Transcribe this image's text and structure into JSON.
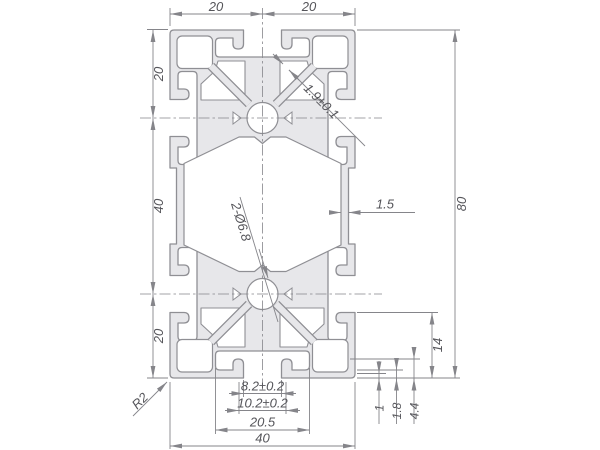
{
  "drawing": {
    "colors": {
      "profile_fill": "#e7e7ea",
      "profile_stroke": "#8f8f94",
      "dimension_line": "#85858a",
      "text": "#55555a"
    },
    "dimensions": {
      "top_width_left": "20",
      "top_width_right": "20",
      "left_height_top": "20",
      "left_height_middle": "40",
      "left_height_bottom": "20",
      "overall_height": "80",
      "lip_thickness": "1.9±0.1",
      "wall_thickness": "1.5",
      "center_holes": "2-Ø6.8",
      "slot_opening": "8.2±0.2",
      "slot_neck": "10.2±0.2",
      "slot_cavity_width": "20.5",
      "overall_width": "40",
      "slot_depth": "14",
      "hook_depth": "4.4",
      "face_lip": "1.8",
      "step": "1",
      "corner_radius": "R2"
    }
  }
}
